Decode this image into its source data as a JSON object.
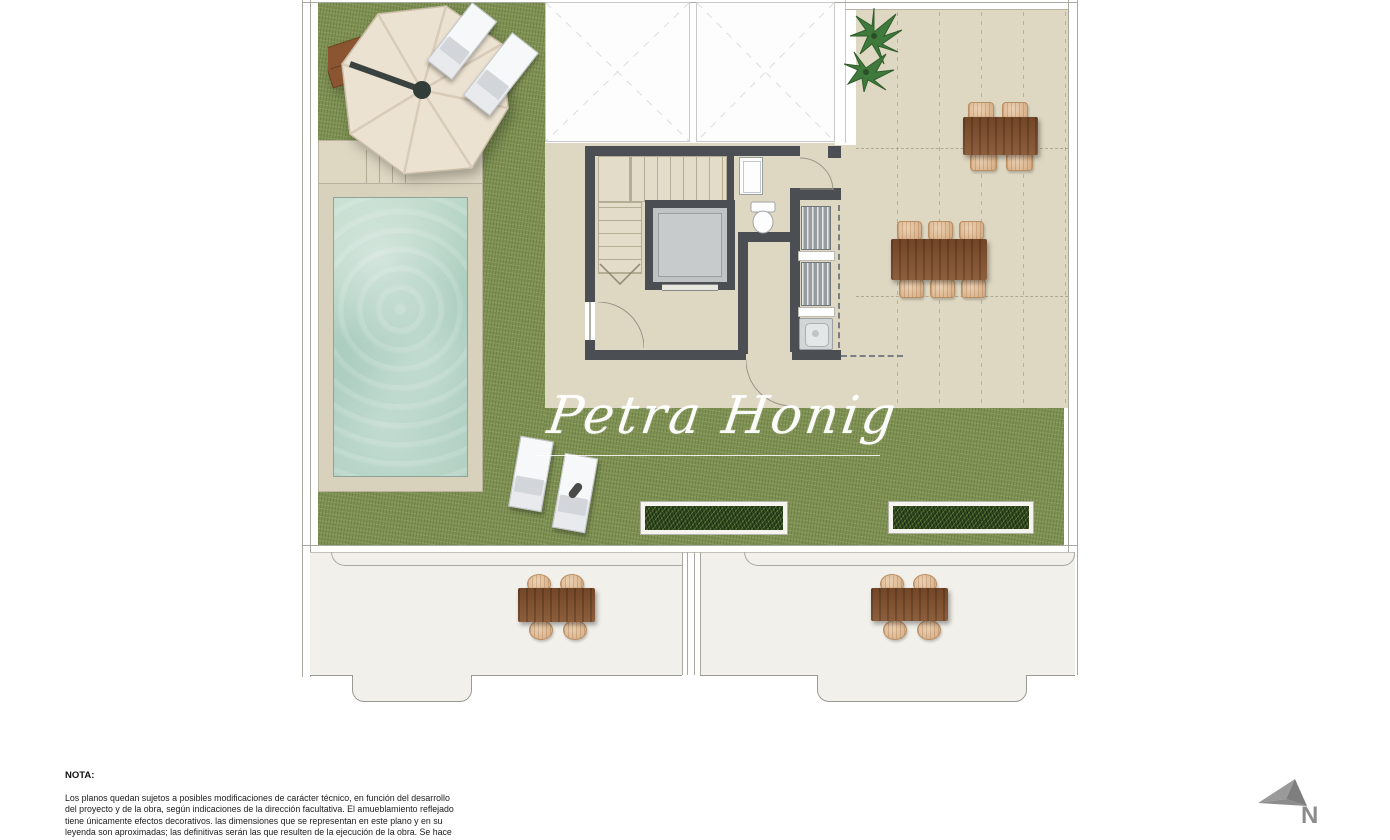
{
  "plan": {
    "watermark_text": "Petra Honig",
    "compass_label": "N",
    "features": [
      "grass-lawn",
      "swimming-pool",
      "pool-deck",
      "parasol",
      "parasol-base",
      "sun-loungers",
      "skylight-voids",
      "stair-core",
      "staircase",
      "elevator",
      "washbasin",
      "toilet",
      "laundry-closet",
      "washing-machine",
      "dining-table-6-seats",
      "dining-table-4-seats",
      "lower-terrace-tables",
      "planters",
      "potted-plant",
      "north-arrow"
    ]
  },
  "note": {
    "title": "NOTA:",
    "lines": [
      "Los planos quedan sujetos a posibles modificaciones de carácter técnico, en función del desarrollo",
      "del proyecto y de la obra, según indicaciones de la dirección facultativa. El amueblamiento reflejado",
      "tiene únicamente efectos decorativos. las dimensiones que se representan en este plano y en su",
      "leyenda son aproximadas; las definitivas serán las que resulten de la ejecución de la obra. Se hace"
    ]
  },
  "colors": {
    "grass": "#7e9152",
    "paving_beige": "#ded7c2",
    "pool_water": "#a5cabb",
    "pool_deck": "#d8d1bc",
    "wall_dark": "#4b4f54",
    "wood_table": "#84512c",
    "wicker_chair": "#d3a87e",
    "planter_green": "#31491f",
    "terrace_white": "#f2f0ea",
    "outline_gray": "#a9a8a0",
    "arrow_gray": "#8c8c8c"
  }
}
